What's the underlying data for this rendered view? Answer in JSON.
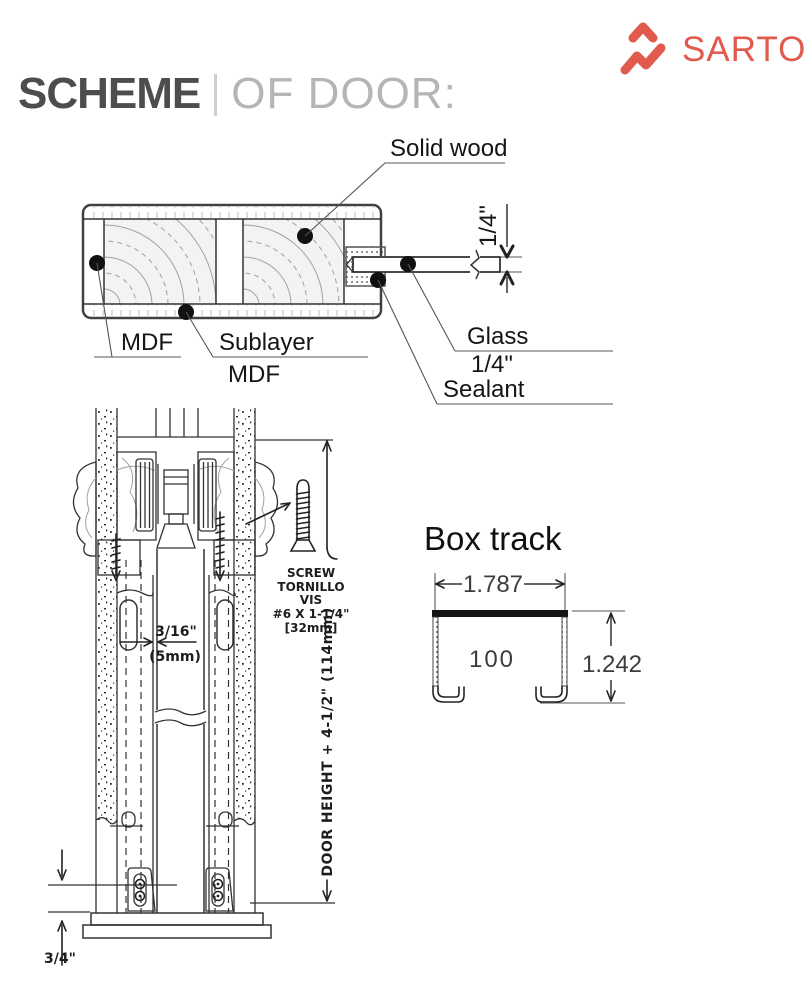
{
  "brand": {
    "name": "SARTO",
    "color": "#E05A4E"
  },
  "header": {
    "title_bold": "SCHEME",
    "title_light": "OF DOOR:"
  },
  "door_section": {
    "solid_wood": "Solid wood",
    "mdf": "MDF",
    "sublayer_line1": "Sublayer",
    "sublayer_line2": "MDF",
    "glass_line1": "Glass",
    "glass_line2": "1/4\"",
    "sealant": "Sealant",
    "glass_thickness": "1/4\""
  },
  "track_section": {
    "screw_lines": [
      "SCREW",
      "TORNILLO",
      "VIS",
      "#6 X 1-1/4\"",
      "[32mm]"
    ],
    "gap_line1": "3/16\"",
    "gap_line2": "(5mm)",
    "door_height": "DOOR HEIGHT + 4-1/2\" (114mm)",
    "bottom_clearance": "3/4\""
  },
  "box_track": {
    "title": "Box track",
    "width": "1.787",
    "height": "1.242",
    "model": "100"
  }
}
